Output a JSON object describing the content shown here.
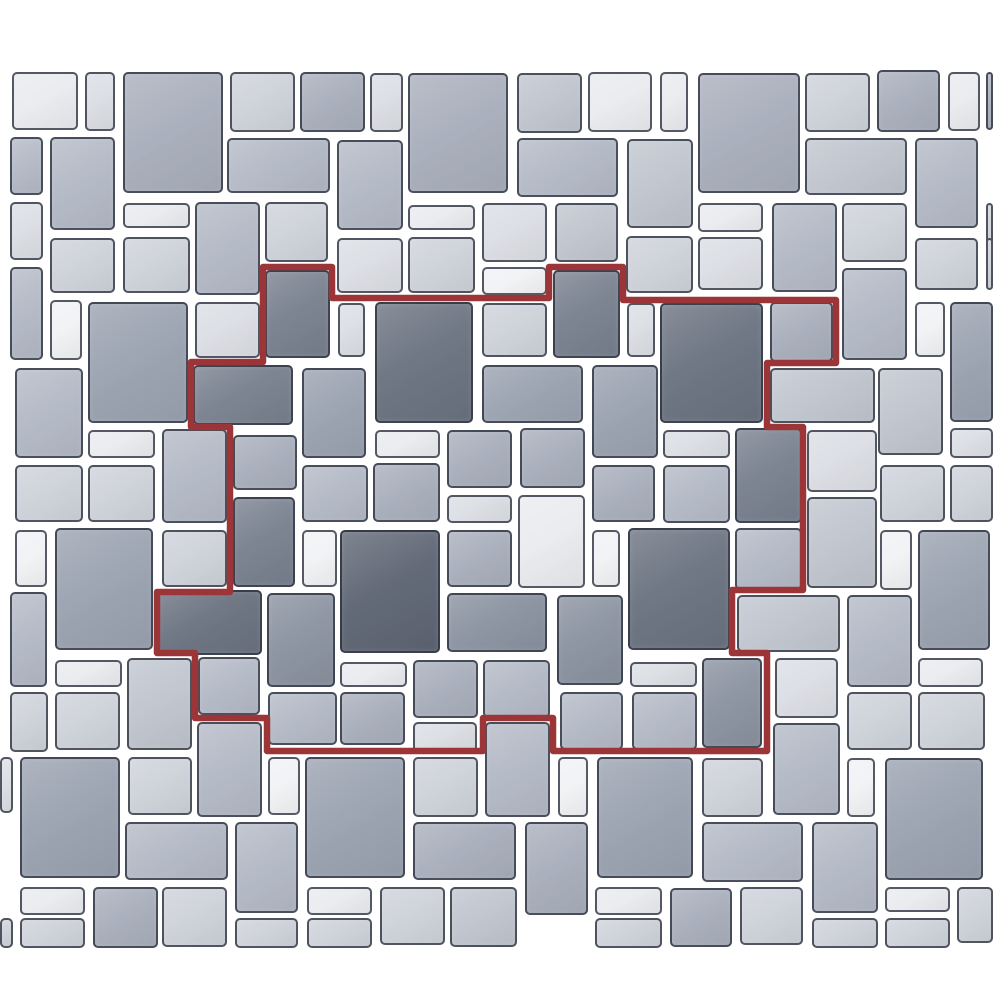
{
  "scene": {
    "description": "paver-tile-pattern-preview",
    "background": "#ffffff",
    "canvas_width": 1000,
    "canvas_height": 1000
  },
  "palette": {
    "border": "#2a303e",
    "red": "#9c3538",
    "s1": "#5e6573",
    "s2": "#6a7280",
    "s3": "#78808e",
    "s4": "#8a92a0",
    "s5": "#9aa2b0",
    "s6": "#a8aebb",
    "s7": "#b3b9c5",
    "s8": "#c0c5ce",
    "s9": "#ced2d9",
    "s10": "#dbdee4",
    "s11": "#e9ebef",
    "s12": "#f0f2f5"
  },
  "tiles": [
    [
      12,
      72,
      66,
      58,
      "s11"
    ],
    [
      85,
      72,
      30,
      59,
      "s10"
    ],
    [
      123,
      72,
      100,
      121,
      "s6"
    ],
    [
      230,
      72,
      65,
      60,
      "s9"
    ],
    [
      300,
      72,
      65,
      60,
      "s6"
    ],
    [
      370,
      73,
      33,
      59,
      "s10"
    ],
    [
      408,
      73,
      100,
      120,
      "s6"
    ],
    [
      517,
      73,
      65,
      60,
      "s8"
    ],
    [
      588,
      72,
      64,
      60,
      "s11"
    ],
    [
      660,
      72,
      28,
      60,
      "s11"
    ],
    [
      698,
      73,
      102,
      120,
      "s6"
    ],
    [
      805,
      73,
      65,
      59,
      "s9"
    ],
    [
      877,
      70,
      63,
      62,
      "s6"
    ],
    [
      948,
      72,
      32,
      59,
      "s11"
    ],
    [
      986,
      72,
      7,
      58,
      "s6"
    ],
    [
      10,
      137,
      33,
      58,
      "s7"
    ],
    [
      50,
      137,
      65,
      93,
      "s7"
    ],
    [
      227,
      138,
      103,
      55,
      "s7"
    ],
    [
      337,
      140,
      66,
      90,
      "s7"
    ],
    [
      517,
      138,
      101,
      59,
      "s7"
    ],
    [
      627,
      139,
      66,
      89,
      "s8"
    ],
    [
      805,
      138,
      102,
      57,
      "s8"
    ],
    [
      915,
      138,
      63,
      90,
      "s7"
    ],
    [
      10,
      202,
      33,
      58,
      "s10"
    ],
    [
      123,
      203,
      67,
      25,
      "s11"
    ],
    [
      195,
      202,
      65,
      93,
      "s7"
    ],
    [
      265,
      202,
      63,
      60,
      "s9"
    ],
    [
      408,
      205,
      67,
      25,
      "s11"
    ],
    [
      482,
      203,
      65,
      59,
      "s10"
    ],
    [
      555,
      203,
      63,
      59,
      "s8"
    ],
    [
      698,
      203,
      65,
      29,
      "s11"
    ],
    [
      772,
      203,
      65,
      89,
      "s7"
    ],
    [
      842,
      203,
      65,
      59,
      "s9"
    ],
    [
      986,
      203,
      7,
      59,
      "s9"
    ],
    [
      50,
      238,
      65,
      55,
      "s9"
    ],
    [
      123,
      237,
      67,
      56,
      "s9"
    ],
    [
      337,
      238,
      66,
      55,
      "s10"
    ],
    [
      408,
      237,
      67,
      56,
      "s9"
    ],
    [
      482,
      267,
      65,
      28,
      "s12"
    ],
    [
      626,
      236,
      67,
      57,
      "s9"
    ],
    [
      698,
      237,
      65,
      53,
      "s10"
    ],
    [
      915,
      238,
      63,
      52,
      "s9"
    ],
    [
      986,
      238,
      7,
      52,
      "s9"
    ],
    [
      265,
      270,
      65,
      88,
      "s3"
    ],
    [
      553,
      270,
      67,
      88,
      "s3"
    ],
    [
      10,
      267,
      33,
      93,
      "s7"
    ],
    [
      50,
      300,
      32,
      60,
      "s12"
    ],
    [
      88,
      302,
      100,
      121,
      "s5"
    ],
    [
      195,
      302,
      65,
      56,
      "s10"
    ],
    [
      338,
      303,
      27,
      54,
      "s10"
    ],
    [
      375,
      302,
      98,
      121,
      "s2"
    ],
    [
      482,
      303,
      65,
      54,
      "s9"
    ],
    [
      627,
      303,
      28,
      54,
      "s10"
    ],
    [
      660,
      303,
      103,
      120,
      "s2"
    ],
    [
      770,
      302,
      63,
      60,
      "s6"
    ],
    [
      842,
      268,
      65,
      92,
      "s7"
    ],
    [
      915,
      302,
      30,
      55,
      "s12"
    ],
    [
      950,
      302,
      43,
      120,
      "s5"
    ],
    [
      15,
      368,
      68,
      90,
      "s7"
    ],
    [
      193,
      365,
      100,
      60,
      "s3"
    ],
    [
      302,
      368,
      64,
      90,
      "s5"
    ],
    [
      482,
      365,
      101,
      58,
      "s5"
    ],
    [
      592,
      365,
      66,
      93,
      "s5"
    ],
    [
      770,
      368,
      105,
      55,
      "s8"
    ],
    [
      878,
      368,
      65,
      87,
      "s8"
    ],
    [
      950,
      428,
      43,
      30,
      "s10"
    ],
    [
      88,
      430,
      67,
      28,
      "s11"
    ],
    [
      162,
      429,
      65,
      94,
      "s7"
    ],
    [
      233,
      435,
      64,
      55,
      "s6"
    ],
    [
      375,
      430,
      65,
      28,
      "s11"
    ],
    [
      447,
      430,
      65,
      58,
      "s6"
    ],
    [
      520,
      428,
      65,
      60,
      "s6"
    ],
    [
      663,
      430,
      67,
      28,
      "s10"
    ],
    [
      735,
      428,
      67,
      95,
      "s3"
    ],
    [
      807,
      430,
      70,
      62,
      "s10"
    ],
    [
      880,
      465,
      65,
      57,
      "s9"
    ],
    [
      950,
      465,
      43,
      57,
      "s9"
    ],
    [
      15,
      465,
      68,
      57,
      "s9"
    ],
    [
      88,
      465,
      67,
      57,
      "s9"
    ],
    [
      302,
      465,
      66,
      57,
      "s7"
    ],
    [
      373,
      463,
      67,
      59,
      "s6"
    ],
    [
      447,
      495,
      65,
      28,
      "s10"
    ],
    [
      518,
      495,
      67,
      93,
      "s11"
    ],
    [
      592,
      465,
      63,
      57,
      "s6"
    ],
    [
      663,
      465,
      67,
      58,
      "s7"
    ],
    [
      15,
      530,
      32,
      57,
      "s12"
    ],
    [
      55,
      528,
      98,
      122,
      "s5"
    ],
    [
      162,
      530,
      65,
      57,
      "s9"
    ],
    [
      233,
      497,
      62,
      90,
      "s3"
    ],
    [
      302,
      530,
      35,
      57,
      "s12"
    ],
    [
      340,
      530,
      100,
      123,
      "s1"
    ],
    [
      447,
      530,
      65,
      57,
      "s6"
    ],
    [
      592,
      530,
      28,
      57,
      "s12"
    ],
    [
      628,
      528,
      102,
      122,
      "s2"
    ],
    [
      735,
      528,
      67,
      62,
      "s7"
    ],
    [
      807,
      497,
      70,
      91,
      "s8"
    ],
    [
      880,
      530,
      32,
      60,
      "s12"
    ],
    [
      918,
      530,
      72,
      120,
      "s5"
    ],
    [
      10,
      592,
      37,
      95,
      "s7"
    ],
    [
      157,
      590,
      105,
      65,
      "s2"
    ],
    [
      267,
      593,
      68,
      94,
      "s4"
    ],
    [
      447,
      593,
      100,
      59,
      "s4"
    ],
    [
      557,
      595,
      66,
      90,
      "s4"
    ],
    [
      737,
      595,
      103,
      57,
      "s8"
    ],
    [
      847,
      595,
      65,
      92,
      "s7"
    ],
    [
      55,
      660,
      67,
      27,
      "s11"
    ],
    [
      127,
      658,
      65,
      92,
      "s8"
    ],
    [
      198,
      657,
      62,
      58,
      "s7"
    ],
    [
      340,
      662,
      67,
      25,
      "s11"
    ],
    [
      413,
      660,
      65,
      58,
      "s6"
    ],
    [
      483,
      660,
      67,
      58,
      "s7"
    ],
    [
      630,
      662,
      67,
      25,
      "s10"
    ],
    [
      702,
      658,
      60,
      90,
      "s4"
    ],
    [
      775,
      658,
      63,
      60,
      "s10"
    ],
    [
      918,
      658,
      65,
      29,
      "s11"
    ],
    [
      10,
      692,
      38,
      60,
      "s9"
    ],
    [
      55,
      692,
      65,
      58,
      "s9"
    ],
    [
      268,
      692,
      69,
      53,
      "s7"
    ],
    [
      340,
      692,
      65,
      53,
      "s6"
    ],
    [
      413,
      722,
      64,
      30,
      "s10"
    ],
    [
      485,
      722,
      65,
      95,
      "s7"
    ],
    [
      197,
      722,
      65,
      95,
      "s7"
    ],
    [
      560,
      692,
      63,
      58,
      "s7"
    ],
    [
      632,
      692,
      65,
      58,
      "s7"
    ],
    [
      847,
      692,
      65,
      58,
      "s9"
    ],
    [
      918,
      692,
      67,
      58,
      "s9"
    ],
    [
      773,
      723,
      67,
      92,
      "s7"
    ],
    [
      0,
      757,
      13,
      56,
      "s10"
    ],
    [
      20,
      757,
      100,
      121,
      "s5"
    ],
    [
      128,
      757,
      64,
      58,
      "s9"
    ],
    [
      268,
      757,
      32,
      58,
      "s12"
    ],
    [
      305,
      757,
      100,
      121,
      "s5"
    ],
    [
      413,
      757,
      65,
      60,
      "s9"
    ],
    [
      525,
      822,
      63,
      93,
      "s6"
    ],
    [
      558,
      757,
      30,
      60,
      "s12"
    ],
    [
      597,
      757,
      96,
      121,
      "s5"
    ],
    [
      702,
      758,
      61,
      59,
      "s9"
    ],
    [
      847,
      758,
      28,
      59,
      "s12"
    ],
    [
      885,
      758,
      98,
      122,
      "s5"
    ],
    [
      125,
      822,
      103,
      58,
      "s7"
    ],
    [
      235,
      822,
      63,
      91,
      "s7"
    ],
    [
      702,
      822,
      101,
      60,
      "s7"
    ],
    [
      812,
      822,
      66,
      91,
      "s7"
    ],
    [
      413,
      822,
      103,
      58,
      "s6"
    ],
    [
      0,
      918,
      13,
      30,
      "s9"
    ],
    [
      20,
      887,
      65,
      28,
      "s11"
    ],
    [
      20,
      918,
      65,
      30,
      "s9"
    ],
    [
      93,
      887,
      65,
      61,
      "s6"
    ],
    [
      162,
      887,
      65,
      60,
      "s9"
    ],
    [
      235,
      918,
      63,
      30,
      "s9"
    ],
    [
      307,
      887,
      65,
      28,
      "s11"
    ],
    [
      307,
      918,
      65,
      30,
      "s9"
    ],
    [
      380,
      887,
      65,
      58,
      "s9"
    ],
    [
      450,
      887,
      67,
      60,
      "s8"
    ],
    [
      595,
      887,
      67,
      28,
      "s11"
    ],
    [
      595,
      918,
      67,
      30,
      "s9"
    ],
    [
      670,
      888,
      62,
      59,
      "s6"
    ],
    [
      740,
      887,
      63,
      58,
      "s9"
    ],
    [
      812,
      918,
      66,
      30,
      "s9"
    ],
    [
      885,
      887,
      65,
      25,
      "s11"
    ],
    [
      885,
      918,
      65,
      30,
      "s9"
    ],
    [
      957,
      887,
      36,
      56,
      "s9"
    ]
  ],
  "repeat_outline": {
    "color": "#9c3538",
    "stroke_width": 6.5,
    "points": [
      [
        263,
        267
      ],
      [
        332,
        267
      ],
      [
        332,
        298
      ],
      [
        549,
        298
      ],
      [
        549,
        267
      ],
      [
        623,
        267
      ],
      [
        623,
        300
      ],
      [
        836,
        300
      ],
      [
        836,
        363
      ],
      [
        767,
        363
      ],
      [
        767,
        427
      ],
      [
        803,
        427
      ],
      [
        803,
        590
      ],
      [
        732,
        590
      ],
      [
        732,
        653
      ],
      [
        767,
        653
      ],
      [
        767,
        751
      ],
      [
        553,
        751
      ],
      [
        553,
        718
      ],
      [
        483,
        718
      ],
      [
        483,
        751
      ],
      [
        267,
        751
      ],
      [
        267,
        718
      ],
      [
        195,
        718
      ],
      [
        195,
        653
      ],
      [
        157,
        653
      ],
      [
        157,
        592
      ],
      [
        230,
        592
      ],
      [
        230,
        427
      ],
      [
        191,
        427
      ],
      [
        191,
        362
      ],
      [
        263,
        362
      ]
    ]
  }
}
